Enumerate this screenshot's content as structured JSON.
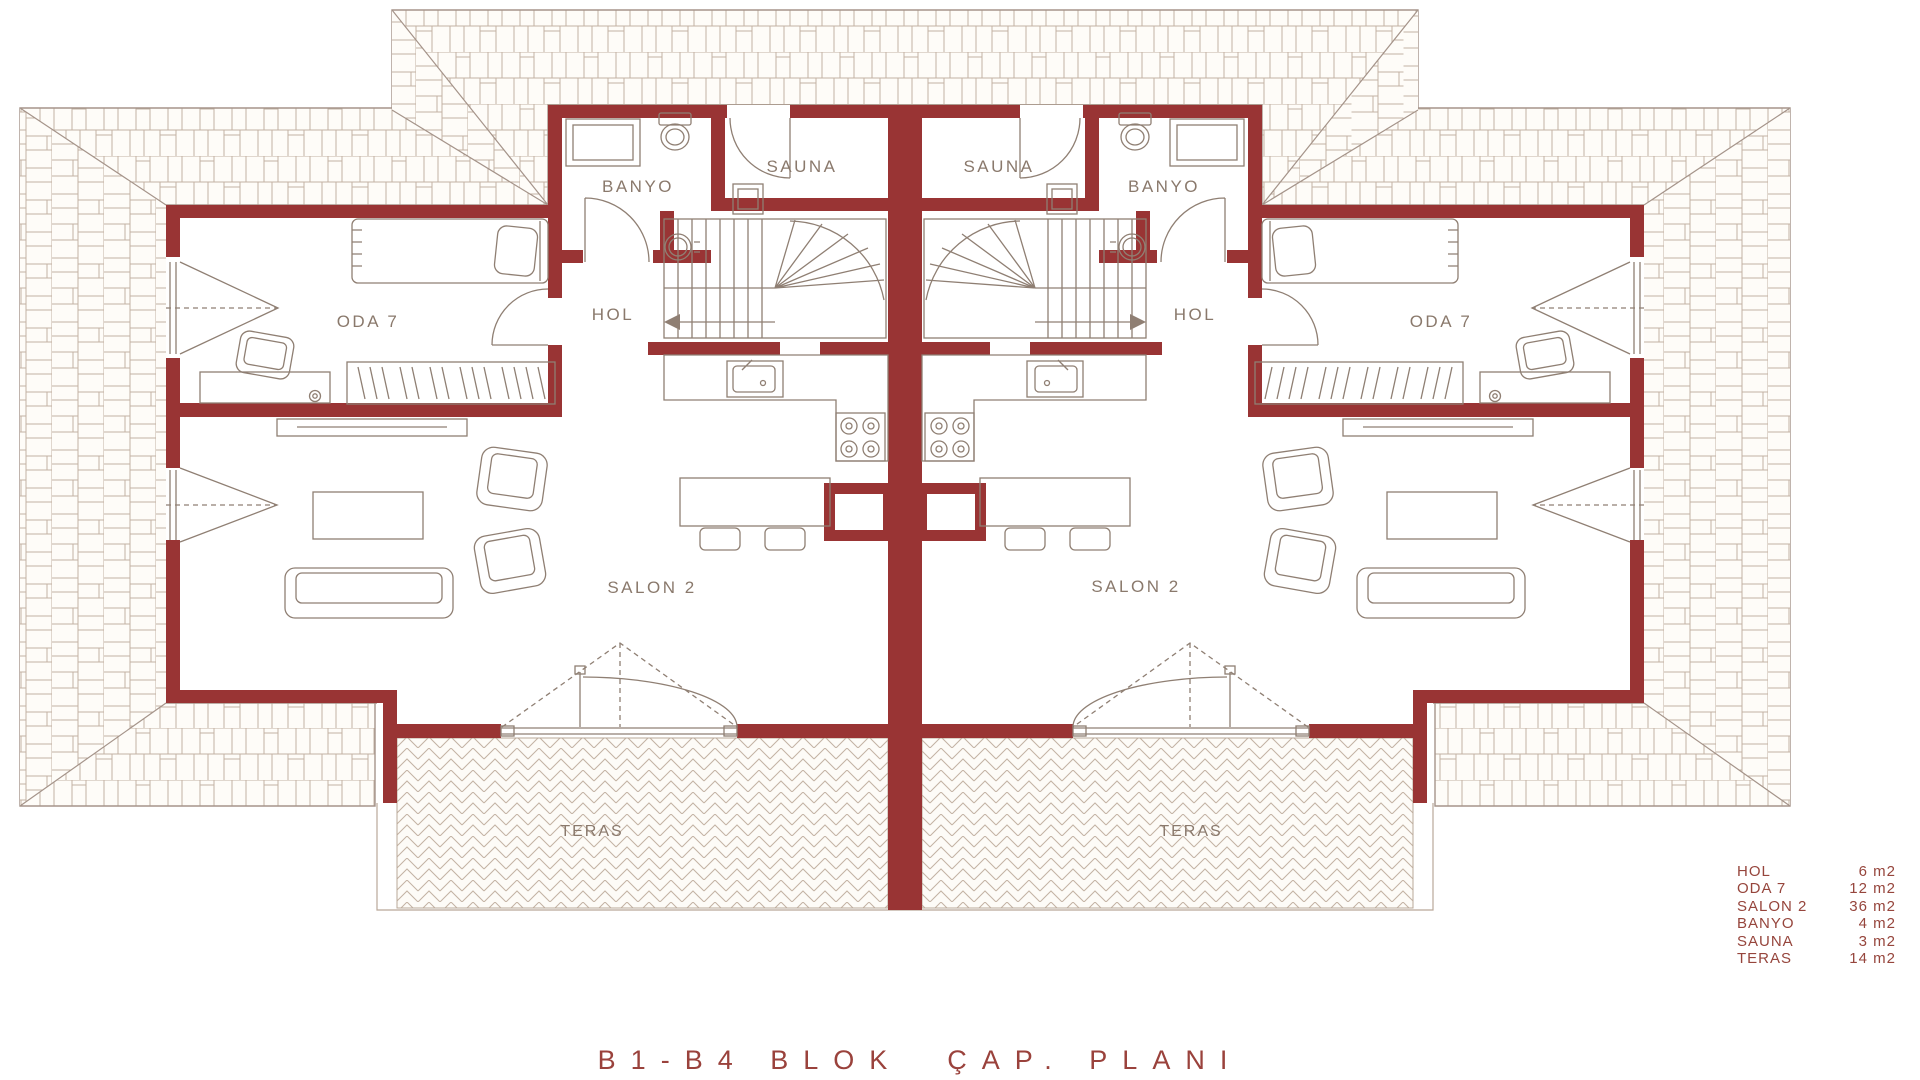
{
  "title": "B1-B4 BLOK  ÇAP. PLANI",
  "rooms": {
    "banyo": "BANYO",
    "sauna": "SAUNA",
    "hol": "HOL",
    "oda": "ODA 7",
    "salon": "SALON 2",
    "teras": "TERAS"
  },
  "legend": {
    "rows": [
      {
        "name": "HOL",
        "area": "6 m2"
      },
      {
        "name": "ODA 7",
        "area": "12 m2"
      },
      {
        "name": "SALON 2",
        "area": "36 m2"
      },
      {
        "name": "BANYO",
        "area": "4 m2"
      },
      {
        "name": "SAUNA",
        "area": "3 m2"
      },
      {
        "name": "TERAS",
        "area": "14 m2"
      }
    ]
  },
  "colors": {
    "wall": "#993434",
    "furniture_line": "#8f7f73",
    "roof_line": "#a5948a",
    "shingle_line": "#c3b2a3",
    "label": "#8a796c",
    "accent": "#96453c"
  }
}
